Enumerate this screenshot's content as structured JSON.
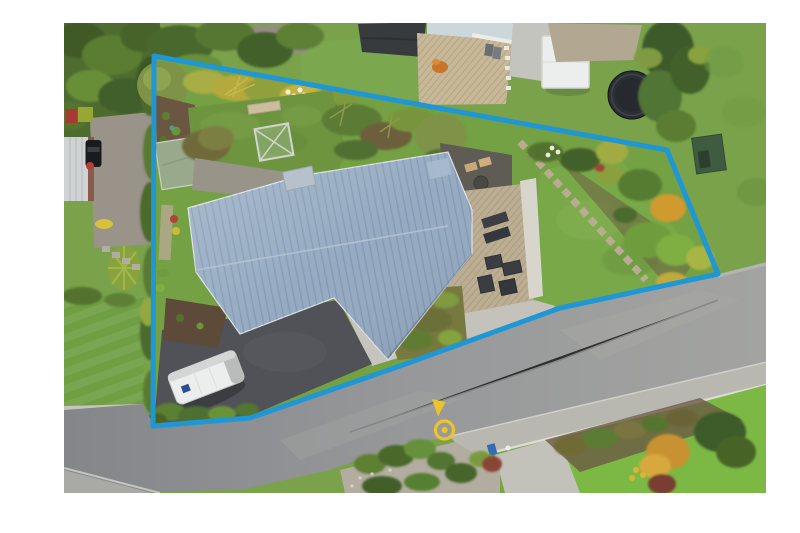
{
  "image": {
    "type": "aerial-property-photograph",
    "width": 800,
    "height": 533
  },
  "canvas": {
    "background": "#ffffff",
    "photo_frame": {
      "x": 64,
      "y": 23,
      "width": 702,
      "height": 470
    }
  },
  "overlay": {
    "boundary": {
      "color": "#1e97d6",
      "stroke_width": 5,
      "points": "154,56 667,150 718,274 560,308 400,366 250,418 153,426"
    },
    "marker": {
      "color": "#ecc32b",
      "ring": {
        "cx": 444.5,
        "cy": 430,
        "r": 9,
        "stroke_width": 3.2
      },
      "dot": {
        "cx": 444.5,
        "cy": 430,
        "r": 3.1
      },
      "triangle_points": "432,399 445.5,402 438,416.5"
    }
  },
  "scene": {
    "house_roof": {
      "label": "main house metal roof",
      "color": "#93a9c1"
    },
    "deck": {
      "label": "timber deck",
      "color": "#bcae93"
    },
    "shed": {
      "label": "garden shed",
      "color": "#99a98c"
    },
    "greenhouse": {
      "label": "glasshouse frame",
      "color": "#cfd6cd"
    },
    "caravan": {
      "label": "caravan",
      "color": "#eceded"
    },
    "driveway": {
      "label": "asphalt driveway",
      "color": "#505257"
    },
    "concrete_drive": {
      "label": "concrete driveway",
      "color": "#c6c4bc"
    },
    "road": {
      "label": "street",
      "color": "#939596"
    },
    "trampoline": {
      "label": "trampoline",
      "color": "#2b2e32"
    },
    "neighbor_shed": {
      "label": "green garden shed",
      "color": "#3f5c40"
    },
    "lawns": {
      "main": "#74a144",
      "right": "#78a847",
      "bottom_right": "#7cb844",
      "neighbor_left": "#6f9e43",
      "neighbor_top": "#7ba74f"
    }
  }
}
